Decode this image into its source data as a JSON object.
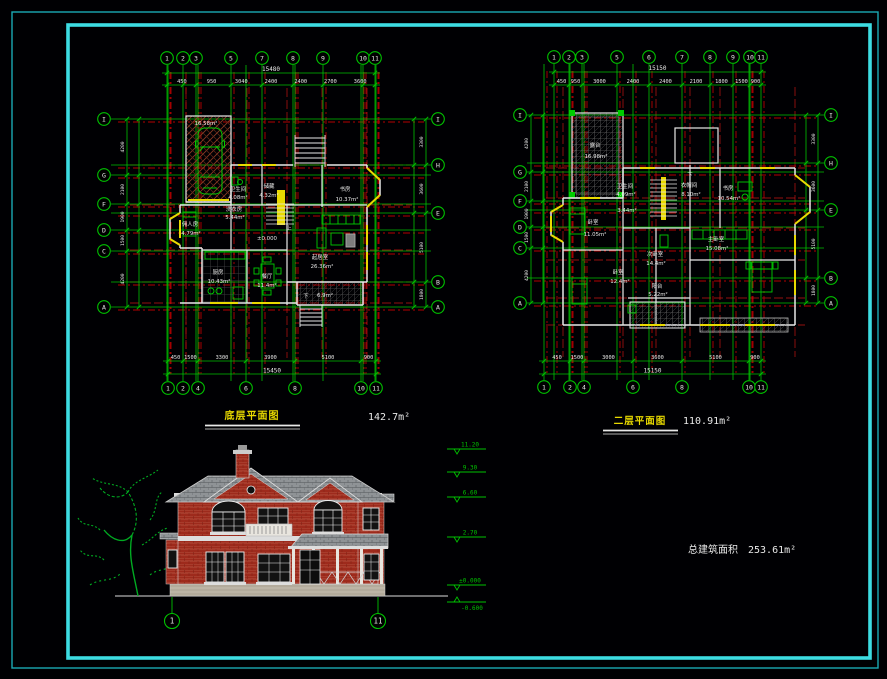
{
  "colors": {
    "frame_outer": "#1ba9b4",
    "frame_inner": "#3ddce2",
    "axis_green": "#00c200",
    "grid_red": "#b40000",
    "wall_white": "#e8e8e8",
    "accent_yellow": "#e8d900",
    "brick_red": "#9e2a1c",
    "roof_gray": "#8f9396"
  },
  "plan1": {
    "title": "底层平面图",
    "area": "142.7m²",
    "axis_top": [
      "1",
      "2",
      "3",
      "5",
      "7",
      "8",
      "9",
      "10",
      "11"
    ],
    "axis_bottom": [
      "1",
      "2",
      "4",
      "6",
      "8",
      "10",
      "11"
    ],
    "axis_left": [
      "I",
      "G",
      "F",
      "D",
      "C",
      "A"
    ],
    "axis_right": [
      "I",
      "H",
      "E",
      "B",
      "A"
    ],
    "dim_top_total": "15480",
    "dim_top_segs": [
      "450",
      "950",
      "3040",
      "2400",
      "2400",
      "2700",
      "3600"
    ],
    "dim_bottom_total": "15450",
    "dim_bottom_segs": [
      "450",
      "1500",
      "3300",
      "3900",
      "5100",
      "900"
    ],
    "dim_left_segs": [
      "4200",
      "2100",
      "1900",
      "1500",
      "4200"
    ],
    "dim_right_segs": [
      "3300",
      "3600",
      "5100",
      "1800"
    ],
    "rooms": [
      {
        "t": "16.58m²",
        "x": 206,
        "y": 125
      },
      {
        "t": "卫生间",
        "x": 238,
        "y": 191
      },
      {
        "t": "4.08m²",
        "x": 238,
        "y": 199
      },
      {
        "t": "储藏",
        "x": 269,
        "y": 188
      },
      {
        "t": "4.32m²",
        "x": 269,
        "y": 197
      },
      {
        "t": "书房",
        "x": 345,
        "y": 191
      },
      {
        "t": "10.37m²",
        "x": 347,
        "y": 201
      },
      {
        "t": "洗衣房",
        "x": 234,
        "y": 211
      },
      {
        "t": "5.44m²",
        "x": 235,
        "y": 219
      },
      {
        "t": "佣人房",
        "x": 190,
        "y": 226
      },
      {
        "t": "4.79m²",
        "x": 191,
        "y": 235
      },
      {
        "t": "厨房",
        "x": 218,
        "y": 274
      },
      {
        "t": "10.43m²",
        "x": 219,
        "y": 283
      },
      {
        "t": "餐厅",
        "x": 267,
        "y": 278
      },
      {
        "t": "11.4m²",
        "x": 267,
        "y": 287
      },
      {
        "t": "起居室",
        "x": 320,
        "y": 259
      },
      {
        "t": "26.36m²",
        "x": 322,
        "y": 268
      },
      {
        "t": "6.9m²",
        "x": 325,
        "y": 297
      },
      {
        "t": "±0.000",
        "x": 267,
        "y": 240
      },
      {
        "t": "上",
        "x": 289,
        "y": 230
      },
      {
        "t": "下",
        "x": 306,
        "y": 298
      }
    ]
  },
  "plan2": {
    "title": "二层平面图",
    "area": "110.91m²",
    "axis_top": [
      "1",
      "2",
      "3",
      "5",
      "6",
      "7",
      "8",
      "9",
      "10",
      "11"
    ],
    "axis_bottom": [
      "1",
      "2",
      "4",
      "6",
      "8",
      "10",
      "11"
    ],
    "axis_left": [
      "I",
      "G",
      "F",
      "D",
      "C",
      "A"
    ],
    "axis_right": [
      "I",
      "H",
      "E",
      "B",
      "A"
    ],
    "dim_top_total": "15150",
    "dim_top_segs": [
      "450",
      "950",
      "3000",
      "2400",
      "2400",
      "2100",
      "1800",
      "1500",
      "900"
    ],
    "dim_bottom_total": "15150",
    "dim_bottom_segs": [
      "450",
      "1500",
      "3000",
      "3600",
      "5100",
      "900"
    ],
    "dim_left_segs": [
      "4200",
      "2100",
      "1900",
      "1500",
      "4200"
    ],
    "dim_right_segs": [
      "3300",
      "3600",
      "5100",
      "1800"
    ],
    "rooms": [
      {
        "t": "露台",
        "x": 595,
        "y": 147
      },
      {
        "t": "16.98m²",
        "x": 596,
        "y": 158
      },
      {
        "t": "卫生间",
        "x": 625,
        "y": 188
      },
      {
        "t": "4.09m²",
        "x": 626,
        "y": 196
      },
      {
        "t": "3.44m²",
        "x": 627,
        "y": 212
      },
      {
        "t": "衣帽间",
        "x": 689,
        "y": 187
      },
      {
        "t": "8.10m²",
        "x": 691,
        "y": 196
      },
      {
        "t": "书房",
        "x": 728,
        "y": 190
      },
      {
        "t": "10.54m²",
        "x": 729,
        "y": 200
      },
      {
        "t": "卧室",
        "x": 593,
        "y": 224
      },
      {
        "t": "11.05m²",
        "x": 595,
        "y": 236
      },
      {
        "t": "卧室",
        "x": 618,
        "y": 274
      },
      {
        "t": "12.4m²",
        "x": 620,
        "y": 283
      },
      {
        "t": "次卧室",
        "x": 655,
        "y": 256
      },
      {
        "t": "14.4m²",
        "x": 656,
        "y": 265
      },
      {
        "t": "主卧室",
        "x": 716,
        "y": 241
      },
      {
        "t": "15.08m²",
        "x": 717,
        "y": 250
      },
      {
        "t": "阳台",
        "x": 657,
        "y": 288
      },
      {
        "t": "5.22m²",
        "x": 658,
        "y": 296
      },
      {
        "t": "下",
        "x": 690,
        "y": 177
      }
    ]
  },
  "elevation": {
    "levels": [
      "11.20",
      "9.30",
      "6.60",
      "2.70",
      "±0.000",
      "-0.600"
    ],
    "axis_labels": [
      "1",
      "11"
    ]
  },
  "summary": {
    "label": "总建筑面积",
    "value": "253.61m²"
  }
}
